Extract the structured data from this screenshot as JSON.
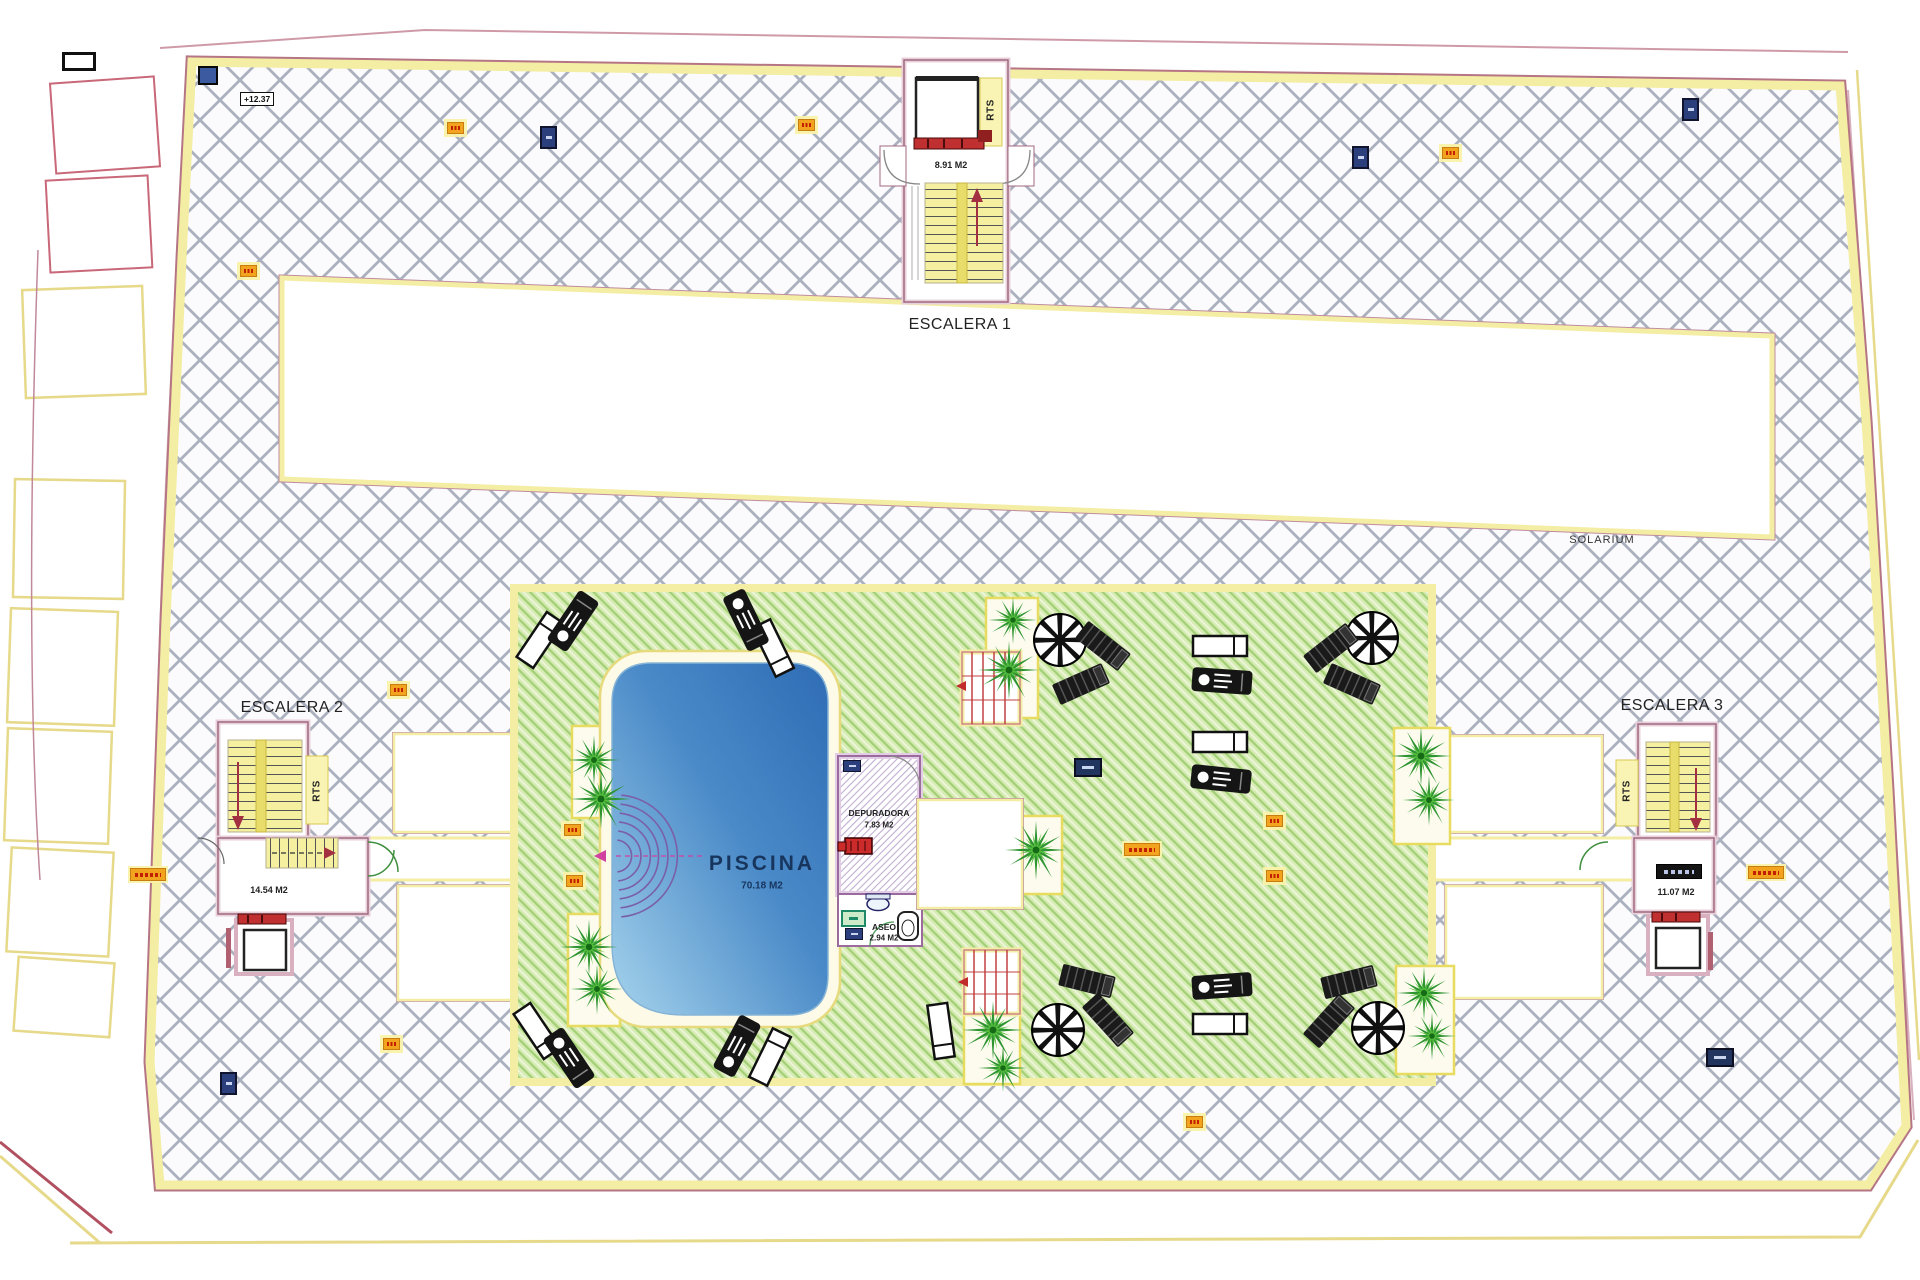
{
  "plan": {
    "stair1": {
      "name": "ESCALERA 1",
      "area": "8.91 M2"
    },
    "stair2": {
      "name": "ESCALERA 2",
      "area": "14.54 M2"
    },
    "stair3": {
      "name": "ESCALERA 3",
      "area": "11.07 M2"
    },
    "solarium_label": "SOLARIUM",
    "pool": {
      "name": "PISCINA",
      "area": "70.18 M2"
    },
    "depuradora": {
      "name": "DEPURADORA",
      "area": "7.83 M2"
    },
    "aseo": {
      "name": "ASEO",
      "area": "2.94 M2"
    },
    "rts_label": "RTS",
    "level_marker": "+12.37"
  },
  "colors": {
    "deck_hatch_line": "#969eac",
    "border_yellow": "#f4eda4",
    "wall_pink": "#b06880",
    "green_base": "#d7ecb4",
    "green_stripe": "#a3d077",
    "pool_dark": "#2f6cb5",
    "pool_light": "#a5d3ec",
    "marker_orange": "#f2a41f",
    "marker_navy": "#2a3f7c",
    "stair_yellow": "#f5efa0",
    "accent_red": "#c22b2b",
    "arc_purple": "#7a5fa8"
  }
}
